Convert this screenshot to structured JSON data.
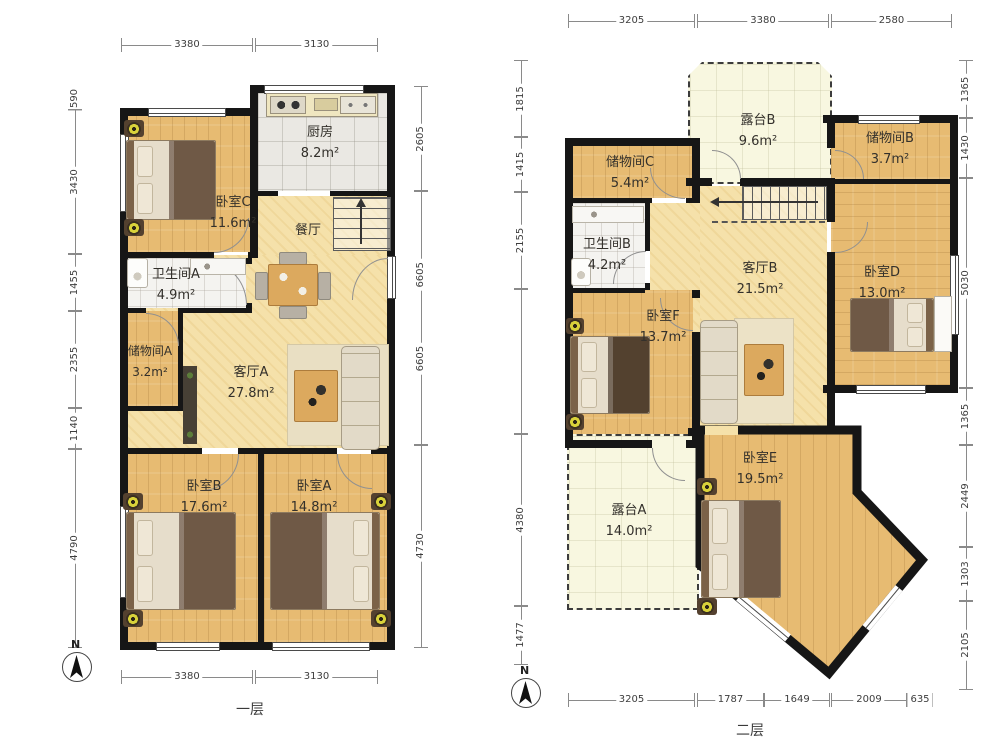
{
  "floor1": {
    "label": "一层",
    "compass": "N",
    "rooms": {
      "kitchen": {
        "name": "厨房",
        "area": "8.2m²"
      },
      "bedroom_c": {
        "name": "卧室C",
        "area": "11.6m²"
      },
      "dining": {
        "name": "餐厅"
      },
      "bath_a": {
        "name": "卫生间A",
        "area": "4.9m²"
      },
      "storage_a": {
        "name": "储物间A",
        "area": "3.2m²"
      },
      "living_a": {
        "name": "客厅A",
        "area": "27.8m²"
      },
      "bedroom_b": {
        "name": "卧室B",
        "area": "17.6m²"
      },
      "bedroom_a": {
        "name": "卧室A",
        "area": "14.8m²"
      }
    },
    "dims": {
      "top": [
        "3380",
        "3130"
      ],
      "bottom": [
        "3380",
        "3130"
      ],
      "left": [
        "590",
        "3430",
        "1455",
        "2355",
        "1140",
        "4790"
      ],
      "right": [
        "2605",
        "6605",
        "6605",
        "4730"
      ]
    }
  },
  "floor2": {
    "label": "二层",
    "compass": "N",
    "rooms": {
      "terrace_b": {
        "name": "露台B",
        "area": "9.6m²"
      },
      "storage_c": {
        "name": "储物间C",
        "area": "5.4m²"
      },
      "storage_b": {
        "name": "储物间B",
        "area": "3.7m²"
      },
      "bath_b": {
        "name": "卫生间B",
        "area": "4.2m²"
      },
      "living_b": {
        "name": "客厅B",
        "area": "21.5m²"
      },
      "bedroom_d": {
        "name": "卧室D",
        "area": "13.0m²"
      },
      "bedroom_f": {
        "name": "卧室F",
        "area": "13.7m²"
      },
      "bedroom_e": {
        "name": "卧室E",
        "area": "19.5m²"
      },
      "terrace_a": {
        "name": "露台A",
        "area": "14.0m²"
      }
    },
    "dims": {
      "top": [
        "3205",
        "3380",
        "2580"
      ],
      "bottom": [
        "3205",
        "1787",
        "1649",
        "2009",
        "635"
      ],
      "left": [
        "1815",
        "1415",
        "2155",
        "4380",
        "1477"
      ],
      "right": [
        "1365",
        "1430",
        "5030",
        "1365",
        "2449",
        "1303",
        "2105"
      ]
    }
  },
  "colors": {
    "wall": "#161616",
    "wood": "#e7bb72",
    "wood_light": "#f5e1aa",
    "tile": "#eae8e3",
    "terrace": "#f8f7e0"
  }
}
